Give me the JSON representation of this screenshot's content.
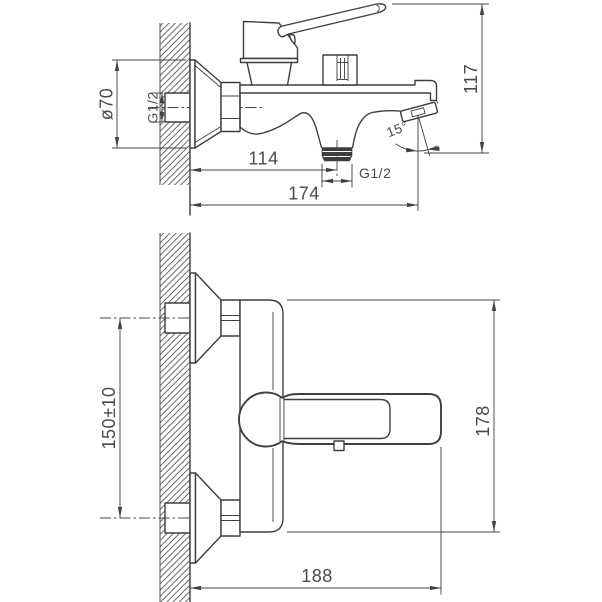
{
  "meta": {
    "title": "Wall-mounted bath mixer faucet — dimensional drawing"
  },
  "colors": {
    "background": "#ffffff",
    "line": "#3f3f3f",
    "text": "#4a4a4a",
    "thread_fill": "#3d3d3d"
  },
  "side_view": {
    "name": "side view",
    "labels": {
      "flange_dia": "ø70",
      "inlet_thread": "G1/2",
      "wall_to_shower_outlet": "114",
      "outlet_thread": "G1/2",
      "wall_to_spout": "174",
      "overall_height": "117",
      "spout_angle": "15°"
    }
  },
  "front_view": {
    "name": "front view",
    "labels": {
      "inlet_spacing": "150±10",
      "body_height": "178",
      "overall_width": "188"
    }
  }
}
